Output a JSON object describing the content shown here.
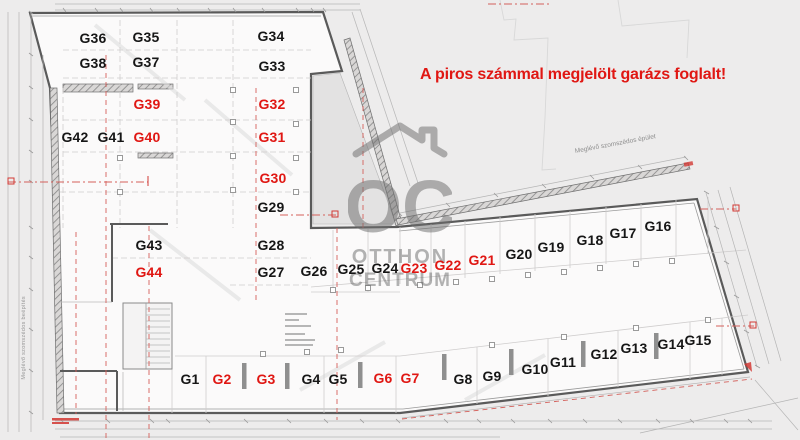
{
  "notice": {
    "text": "A piros számmal megjelölt garázs foglalt!"
  },
  "watermark": {
    "logo": "OC",
    "line1": "OTTHON",
    "line2": "CENTRUM"
  },
  "labels": {
    "neighbor_building": "Meglévő szomszédos épület",
    "neighbor_side": "Meglévő szomszédos beépítés"
  },
  "colors": {
    "occupied": "#e01713",
    "available": "#161616",
    "notice": "#e01713",
    "red_line": "#d4605b",
    "wall": "#5a5a5a"
  },
  "garages": [
    {
      "id": "G1",
      "x": 190,
      "y": 379,
      "occupied": false
    },
    {
      "id": "G2",
      "x": 222,
      "y": 379,
      "occupied": true
    },
    {
      "id": "G3",
      "x": 266,
      "y": 379,
      "occupied": true
    },
    {
      "id": "G4",
      "x": 311,
      "y": 379,
      "occupied": false
    },
    {
      "id": "G5",
      "x": 338,
      "y": 379,
      "occupied": false
    },
    {
      "id": "G6",
      "x": 383,
      "y": 378,
      "occupied": true
    },
    {
      "id": "G7",
      "x": 410,
      "y": 378,
      "occupied": true
    },
    {
      "id": "G8",
      "x": 463,
      "y": 379,
      "occupied": false
    },
    {
      "id": "G9",
      "x": 492,
      "y": 376,
      "occupied": false
    },
    {
      "id": "G10",
      "x": 535,
      "y": 369,
      "occupied": false
    },
    {
      "id": "G11",
      "x": 563,
      "y": 362,
      "occupied": false
    },
    {
      "id": "G12",
      "x": 604,
      "y": 354,
      "occupied": false
    },
    {
      "id": "G13",
      "x": 634,
      "y": 348,
      "occupied": false
    },
    {
      "id": "G14",
      "x": 671,
      "y": 344,
      "occupied": false
    },
    {
      "id": "G15",
      "x": 698,
      "y": 340,
      "occupied": false
    },
    {
      "id": "G16",
      "x": 658,
      "y": 226,
      "occupied": false
    },
    {
      "id": "G17",
      "x": 623,
      "y": 233,
      "occupied": false
    },
    {
      "id": "G18",
      "x": 590,
      "y": 240,
      "occupied": false
    },
    {
      "id": "G19",
      "x": 551,
      "y": 247,
      "occupied": false
    },
    {
      "id": "G20",
      "x": 519,
      "y": 254,
      "occupied": false
    },
    {
      "id": "G21",
      "x": 482,
      "y": 260,
      "occupied": true
    },
    {
      "id": "G22",
      "x": 448,
      "y": 265,
      "occupied": true
    },
    {
      "id": "G23",
      "x": 414,
      "y": 268,
      "occupied": true
    },
    {
      "id": "G24",
      "x": 385,
      "y": 268,
      "occupied": false
    },
    {
      "id": "G25",
      "x": 351,
      "y": 269,
      "occupied": false
    },
    {
      "id": "G26",
      "x": 314,
      "y": 271,
      "occupied": false
    },
    {
      "id": "G27",
      "x": 271,
      "y": 272,
      "occupied": false
    },
    {
      "id": "G28",
      "x": 271,
      "y": 245,
      "occupied": false
    },
    {
      "id": "G29",
      "x": 271,
      "y": 207,
      "occupied": false
    },
    {
      "id": "G30",
      "x": 273,
      "y": 178,
      "occupied": true
    },
    {
      "id": "G31",
      "x": 272,
      "y": 137,
      "occupied": true
    },
    {
      "id": "G32",
      "x": 272,
      "y": 104,
      "occupied": true
    },
    {
      "id": "G33",
      "x": 272,
      "y": 66,
      "occupied": false
    },
    {
      "id": "G34",
      "x": 271,
      "y": 36,
      "occupied": false
    },
    {
      "id": "G35",
      "x": 146,
      "y": 37,
      "occupied": false
    },
    {
      "id": "G36",
      "x": 93,
      "y": 38,
      "occupied": false
    },
    {
      "id": "G37",
      "x": 146,
      "y": 62,
      "occupied": false
    },
    {
      "id": "G38",
      "x": 93,
      "y": 63,
      "occupied": false
    },
    {
      "id": "G39",
      "x": 147,
      "y": 104,
      "occupied": true
    },
    {
      "id": "G40",
      "x": 147,
      "y": 137,
      "occupied": true
    },
    {
      "id": "G41",
      "x": 111,
      "y": 137,
      "occupied": false
    },
    {
      "id": "G42",
      "x": 75,
      "y": 137,
      "occupied": false
    },
    {
      "id": "G43",
      "x": 149,
      "y": 245,
      "occupied": false
    },
    {
      "id": "G44",
      "x": 149,
      "y": 272,
      "occupied": true
    }
  ]
}
